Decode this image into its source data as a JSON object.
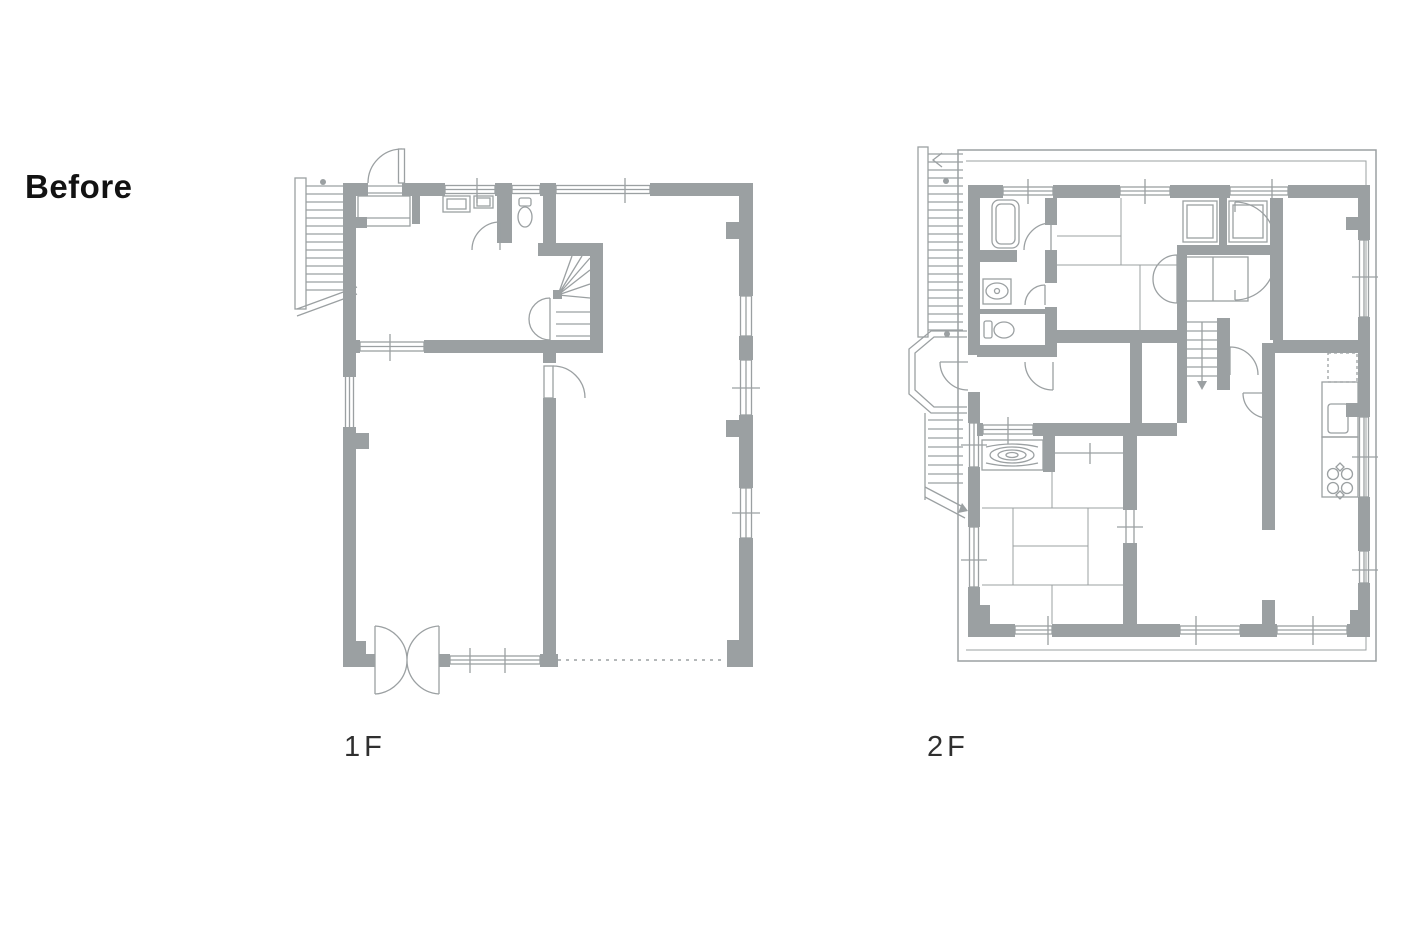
{
  "annotation": {
    "label": "Before"
  },
  "floor_plans": [
    {
      "id": "1f",
      "label": "1F",
      "symbols": [
        "exterior-staircase",
        "entrance-door",
        "genkan-step",
        "shoe-cabinet",
        "toilet",
        "winder-staircase",
        "hinged-door",
        "double-swing-entrance-door",
        "window",
        "dashed-open-boundary"
      ]
    },
    {
      "id": "2f",
      "label": "2F",
      "symbols": [
        "exterior-staircase",
        "stair-landing",
        "bathtub",
        "washbasin",
        "toilet",
        "tatami-room",
        "tokonoma-wood-grain",
        "closet",
        "interior-staircase-down-arrow",
        "hinged-door",
        "kitchen-counter",
        "sink",
        "stove-burners",
        "refrigerator-dashed-outline",
        "window",
        "balcony-outline"
      ]
    }
  ],
  "colors": {
    "wall": "#9ba0a2",
    "annotation_text": "#121212",
    "label_text": "#2f2f2f",
    "background": "#ffffff"
  }
}
